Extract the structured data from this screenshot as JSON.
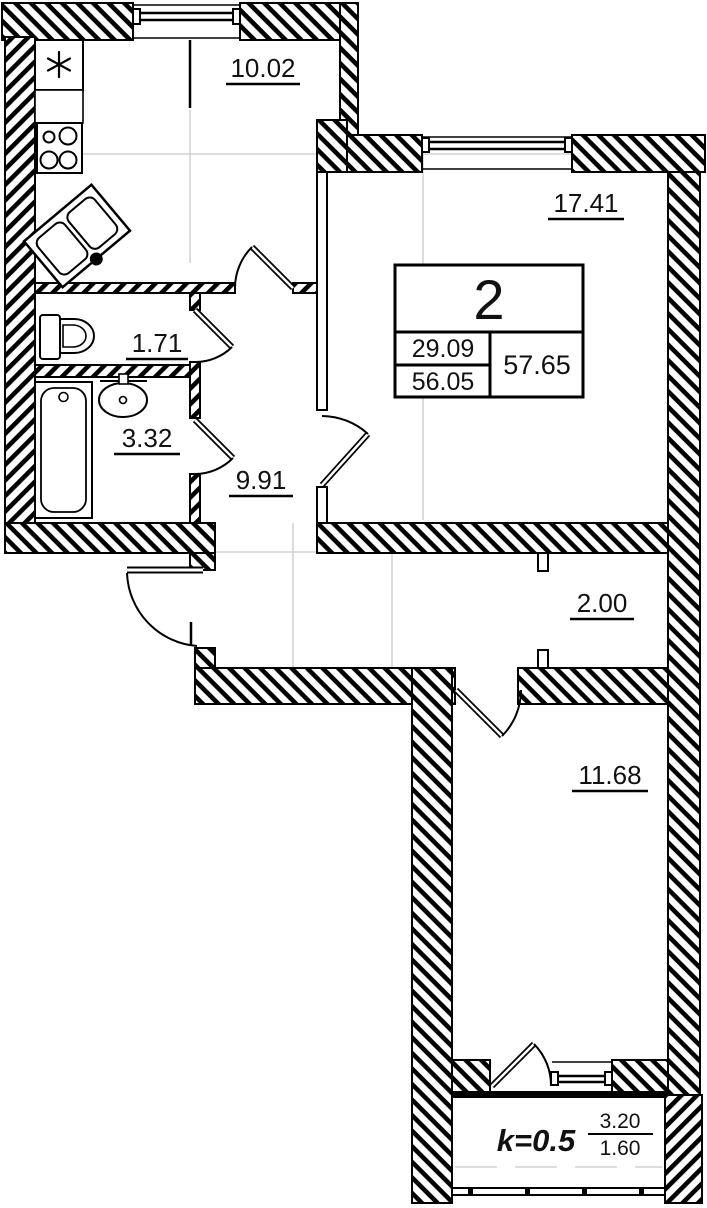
{
  "plan": {
    "title": "2-room apartment floor plan",
    "apartment": {
      "number": "2",
      "living_area": "29.09",
      "area": "56.05",
      "total_area": "57.65"
    },
    "rooms": {
      "kitchen": {
        "area": "10.02"
      },
      "living_room": {
        "area": "17.41"
      },
      "wc": {
        "area": "1.71"
      },
      "bathroom": {
        "area": "3.32"
      },
      "hallway": {
        "area": "9.91"
      },
      "corridor": {
        "area": "2.00"
      },
      "bedroom": {
        "area": "11.68"
      },
      "balcony": {
        "coefficient": "k=0.5",
        "area_full": "3.20",
        "area_reduced": "1.60"
      }
    },
    "colors": {
      "walls": "#000000",
      "background": "#ffffff",
      "axis_line": "#c9c9c9"
    }
  }
}
